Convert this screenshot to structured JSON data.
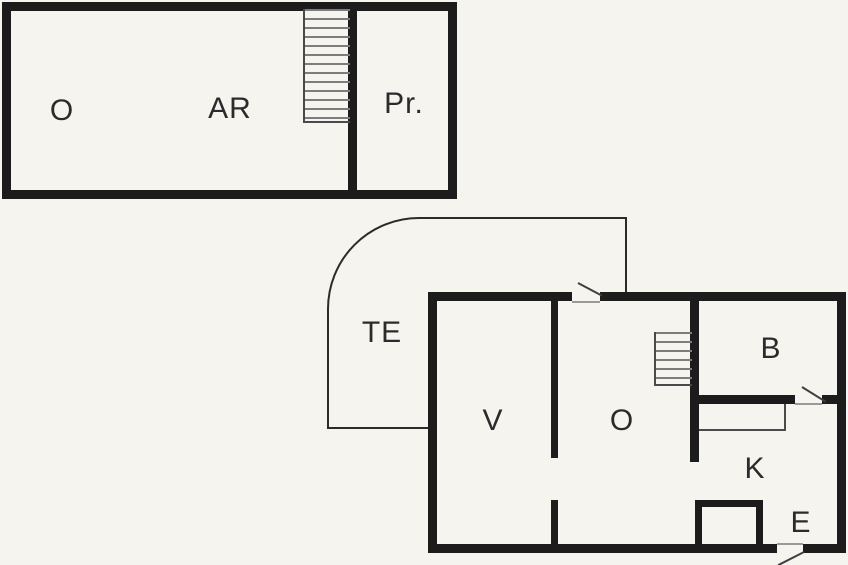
{
  "title": "Two-level floor plan",
  "colors": {
    "background": "#f6f4ef",
    "wall": "#1c1c1c",
    "thin_line": "#4a4a4a",
    "stair_tread": "#7d7d7d",
    "label": "#2b2b2b"
  },
  "upper_floor": {
    "rooms": [
      {
        "key": "o",
        "label": "O"
      },
      {
        "key": "ar",
        "label": "AR"
      },
      {
        "key": "pr",
        "label": "Pr."
      }
    ],
    "features": [
      "staircase"
    ]
  },
  "ground_floor": {
    "rooms": [
      {
        "key": "te",
        "label": "TE"
      },
      {
        "key": "v",
        "label": "V"
      },
      {
        "key": "o",
        "label": "O"
      },
      {
        "key": "b",
        "label": "B"
      },
      {
        "key": "k",
        "label": "K"
      },
      {
        "key": "e",
        "label": "E"
      }
    ],
    "features": [
      "staircase",
      "curved-terrace-corner",
      "kitchen-counter",
      "closet",
      "door-top",
      "door-b",
      "door-entrance"
    ]
  }
}
